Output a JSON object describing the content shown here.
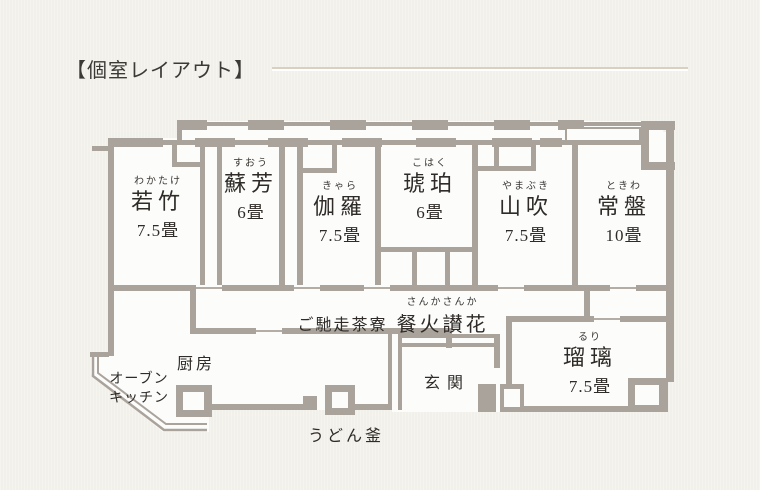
{
  "title": "【個室レイアウト】",
  "colors": {
    "background": "#f2f0ea",
    "floor": "#fcfcfa",
    "wall": "#a9a39c",
    "text": "#2e2b28",
    "divider_tan": "#d9d0bf",
    "divider_white": "#ffffff"
  },
  "rooms": [
    {
      "furigana": "わかたけ",
      "name": "若竹",
      "size": "7.5畳"
    },
    {
      "furigana": "すおう",
      "name": "蘇芳",
      "size": "6畳"
    },
    {
      "furigana": "きゃら",
      "name": "伽羅",
      "size": "7.5畳"
    },
    {
      "furigana": "こはく",
      "name": "琥珀",
      "size": "6畳"
    },
    {
      "furigana": "やまぶき",
      "name": "山吹",
      "size": "7.5畳"
    },
    {
      "furigana": "ときわ",
      "name": "常盤",
      "size": "10畳"
    },
    {
      "furigana": "るり",
      "name": "瑠璃",
      "size": "7.5畳"
    }
  ],
  "labels": {
    "restaurant_prefix": "ご馳走茶寮",
    "restaurant_furigana": "さんかさんか",
    "restaurant_name": "餐火讃花",
    "kitchen": "厨房",
    "oven_kitchen_line1": "オーブン",
    "oven_kitchen_line2": "キッチン",
    "entrance": "玄関",
    "udon_pot": "うどん釜"
  }
}
